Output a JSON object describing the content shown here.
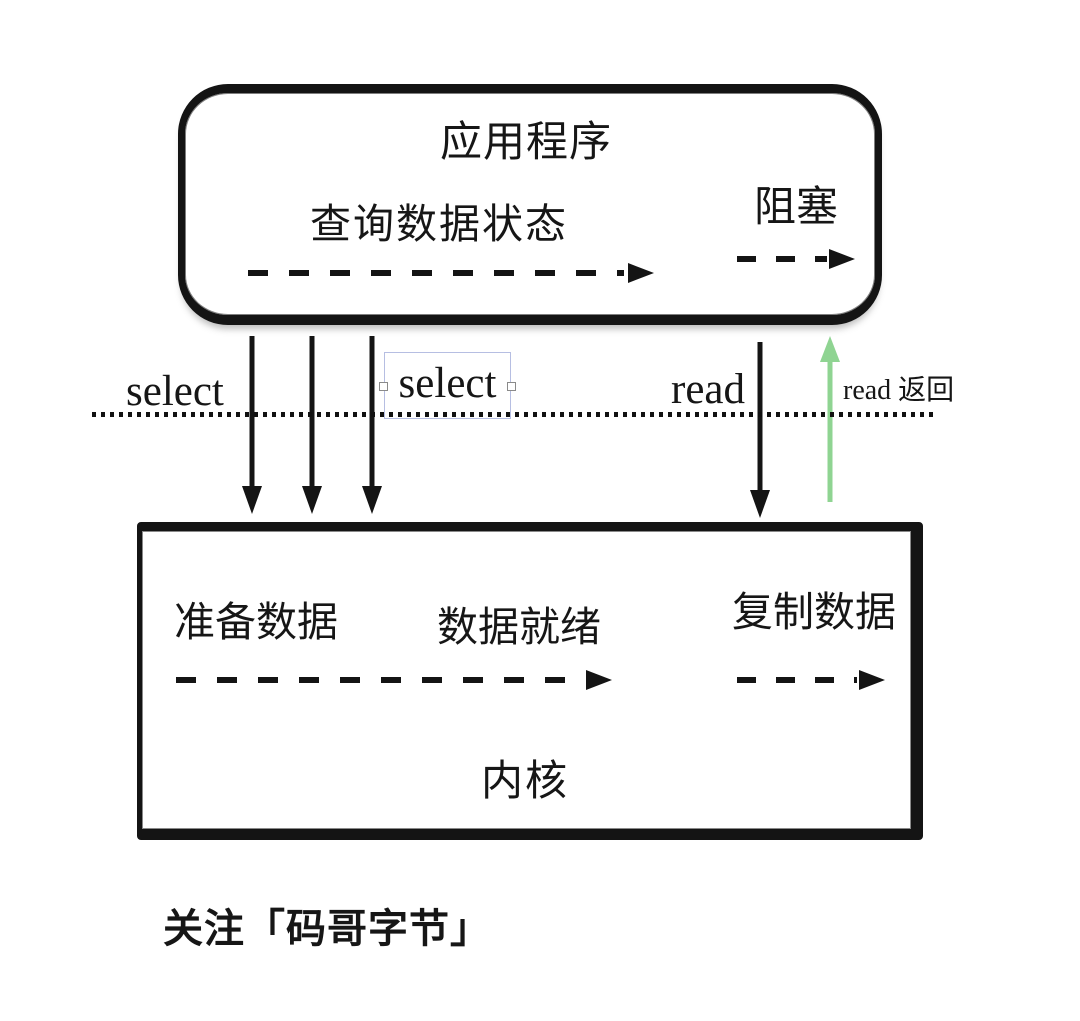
{
  "app_box": {
    "title": "应用程序",
    "query_status": "查询数据状态",
    "blocking": "阻塞"
  },
  "syscalls": {
    "select_left": "select",
    "select_boxed": "select",
    "read": "read",
    "read_return": "read 返回"
  },
  "kernel_box": {
    "prepare": "准备数据",
    "ready": "数据就绪",
    "copy": "复制数据",
    "title": "内核"
  },
  "caption": "关注「码哥字节」",
  "colors": {
    "ink": "#161616",
    "green_arrow": "#8fd492",
    "selection_outline": "#b6bee2"
  }
}
